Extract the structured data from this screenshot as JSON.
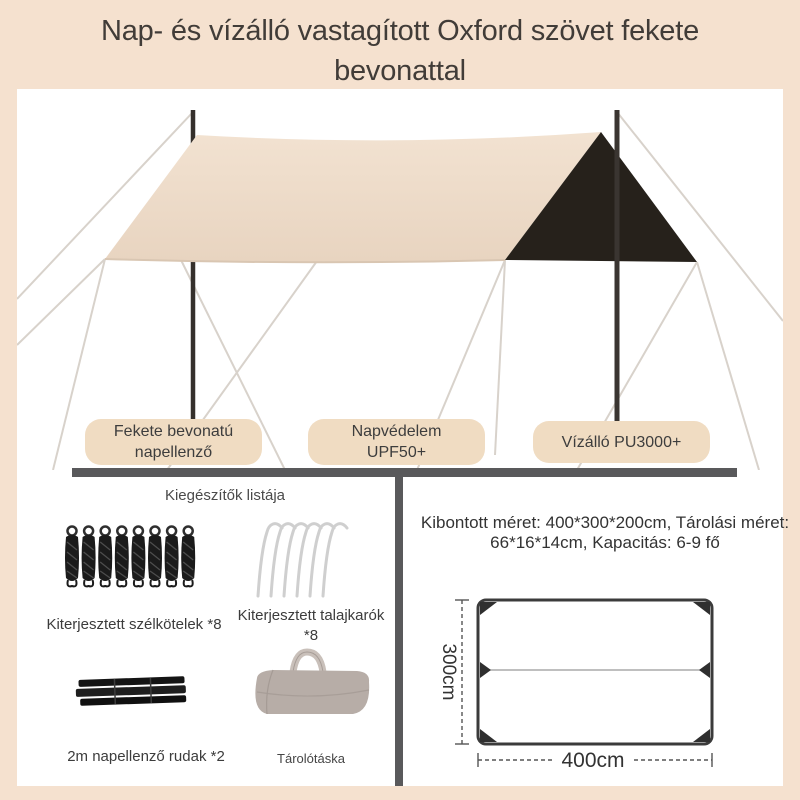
{
  "header": {
    "title": "Nap- és vízálló vastagított Oxford szövet fekete bevonattal"
  },
  "badges": [
    {
      "label": "Fekete bevonatú napellenző"
    },
    {
      "label": "Napvédelem UPF50+"
    },
    {
      "label": "Vízálló PU3000+"
    }
  ],
  "accessories": {
    "title": "Kiegészítők listája",
    "items": [
      {
        "icon": "rope-bundles-icon",
        "label": "Kiterjesztett szélkötelek *8"
      },
      {
        "icon": "tent-stakes-icon",
        "label": "Kiterjesztett talajkarók *8"
      },
      {
        "icon": "folded-poles-icon",
        "label": "2m napellenző rudak *2"
      },
      {
        "icon": "storage-bag-icon",
        "label": "Tárolótáska"
      }
    ]
  },
  "specs": {
    "size_text": "Kibontott méret: 400*300*200cm, Tárolási méret: 66*16*14cm, Kapacitás: 6-9 fő",
    "diagram": {
      "width_label": "400cm",
      "height_label": "300cm"
    }
  },
  "colors": {
    "page_bg": "#f5e1cf",
    "badge_bg": "#f0dcc2",
    "canopy_beige": "#ecd9c5",
    "canopy_black": "#26211b",
    "divider_gray": "#59595b"
  }
}
